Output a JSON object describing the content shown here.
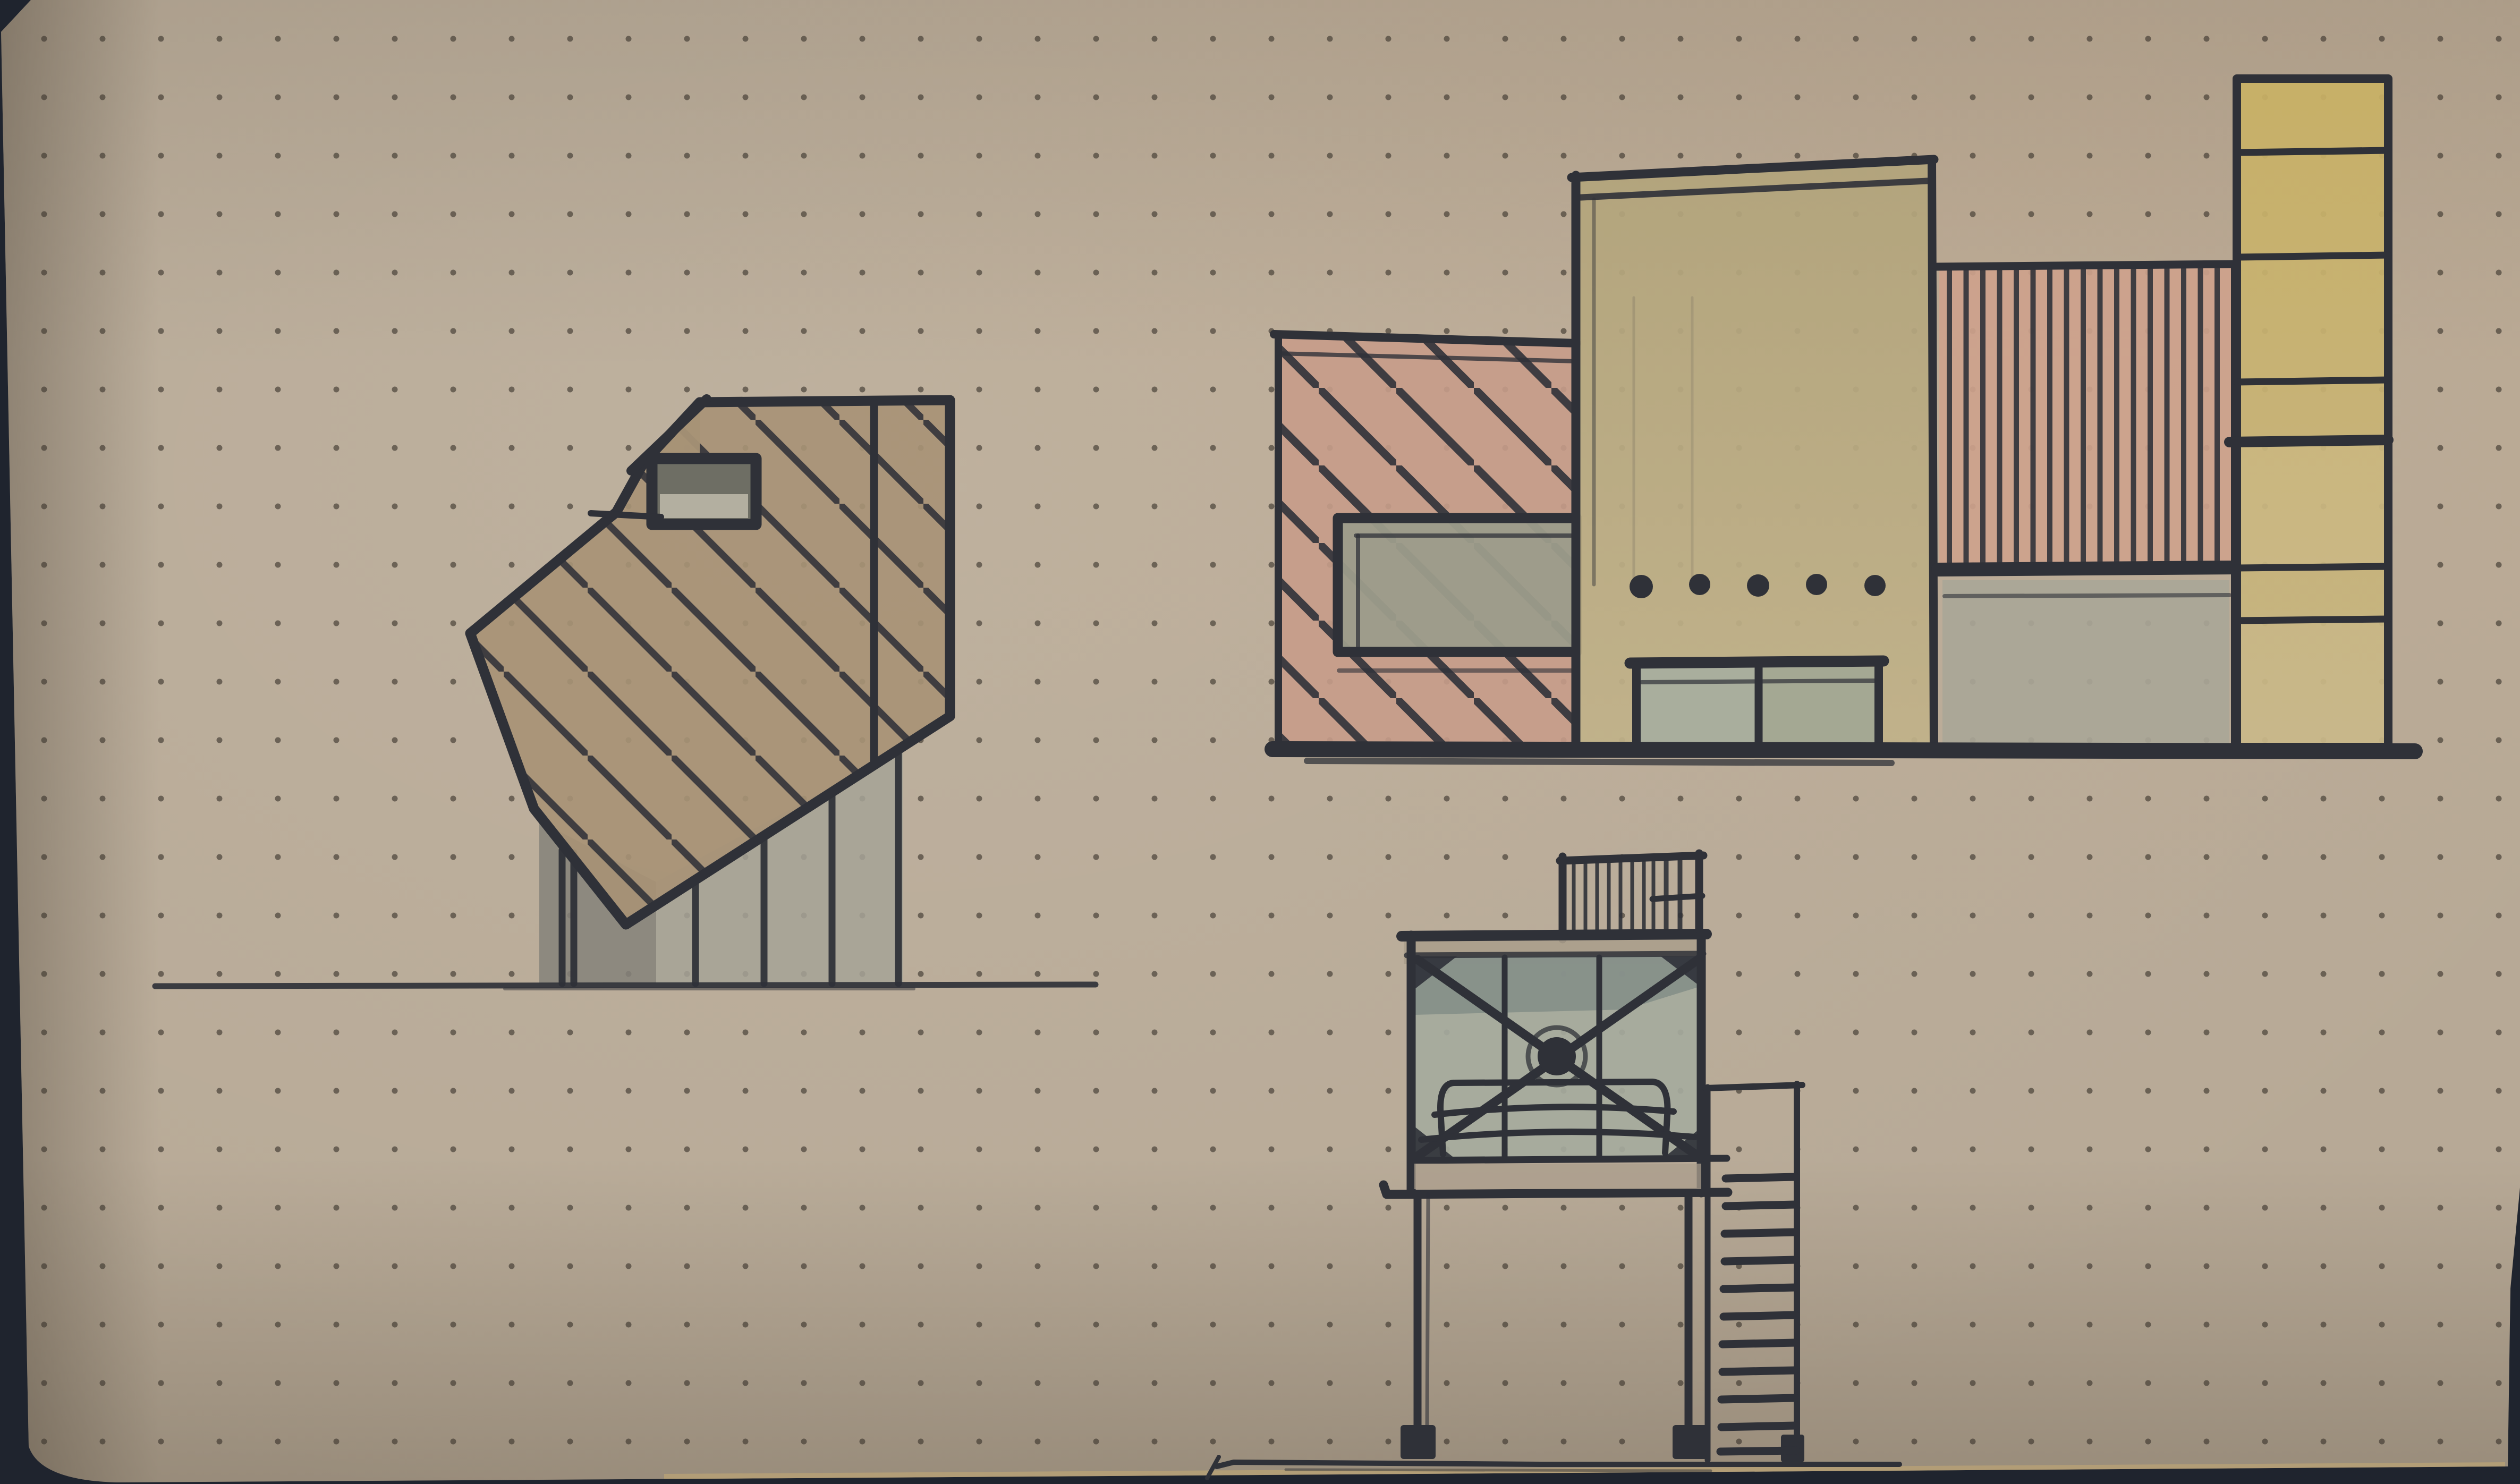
{
  "meta": {
    "title": "Architectural concept sketches — ink and marker on dot-grid kraft paper",
    "medium": "photograph of a sketchbook page on a dark tabletop",
    "visible_text": "none"
  },
  "palette": {
    "table": "#1f242e",
    "paper": "#b7a996",
    "paper_warm": "#c2ad94",
    "paper_cool": "#b2aca0",
    "ink": "#2f3138",
    "dot": "#3a342c",
    "tan_wash": "#a79276",
    "salmon": "#c69c89",
    "salmon_bright": "#cda28c",
    "olive_yellow_top": "#b2a47b",
    "olive_yellow_bottom": "#c1b289",
    "yellow_tower_top": "#c9b164",
    "yellow_tower_bottom": "#c7b583",
    "gray_window": "#9c9c8b",
    "gray_door_a": "#a8ae9e",
    "gray_door_b": "#a2a894",
    "gray_block": "#a9a697",
    "gray_wall_light": "#a6a396",
    "gray_wall_dark": "#85827a",
    "box_interior": "#a5aa9d",
    "box_interior_dark": "#828d87",
    "slab_wash": "#ab9e8c",
    "clerestory_dark": "#6e6e64",
    "clerestory_light": "#b3afa0",
    "edge_highlight": "#c9ad72"
  },
  "paper": {
    "dot_grid_spacing": 110,
    "dot_radius": 5.5,
    "corner": "rounded bottom-left, dark table visible along left, bottom and lower-right edges"
  },
  "sketches": [
    {
      "id": "faceted-house",
      "label": "Faceted hatched house volume on thin stilts with clerestory window — side elevation",
      "features": [
        "diagonal \\ hatching",
        "clerestory box with gray glazing",
        "5 slender posts",
        "gray shadow wall",
        "ground line"
      ]
    },
    {
      "id": "elevation-montage",
      "label": "Street elevation montage of four building volumes",
      "features": [
        "diagonally hatched salmon block with gray ribbon window",
        "tall olive-yellow tower with 5 hand dots and double gray doors",
        "vertically striped salmon panel over gray base",
        "segmented yellow slab tower",
        "heavy ground baseline"
      ]
    },
    {
      "id": "stilt-pavilion",
      "label": "Cross-braced glazed pavilion raised on stilts with roof-deck railing and side stair",
      "features": [
        "X-bracing with center node",
        "two mullions",
        "bench sketch inside",
        "roof railing with dense pickets",
        "two footings",
        "11-tread stair",
        "sketchy ground line"
      ]
    }
  ]
}
